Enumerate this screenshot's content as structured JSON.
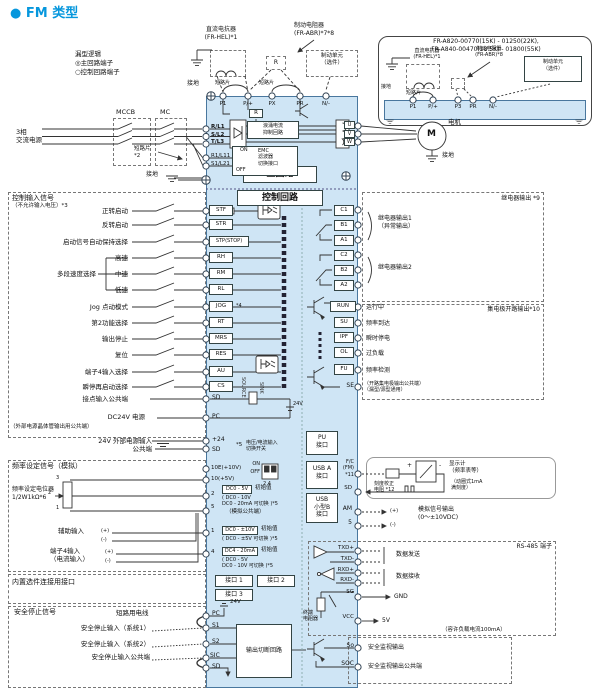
{
  "title": "● FM 类型",
  "legend": {
    "l1": "漏型逻辑",
    "l2": "◎主回路端子",
    "l3": "○控制回路端子"
  },
  "power": {
    "source": "3相\n交流电源",
    "mccb": "MCCB",
    "mc": "MC",
    "jumper": "短路片\n  *2",
    "ground": "接地"
  },
  "reactor": {
    "label": "直流电抗器\n(FR-HEL)*1",
    "ground": "接地",
    "jumper1": "短路片",
    "jumper2": "短路片"
  },
  "brake": {
    "resistor": "制动电阻器\n(FR-ABR)*7*8",
    "unit": "制动单元\n（选件）",
    "r": "R"
  },
  "inset": {
    "title": "FR-A820-00770(15K) - 01250(22K),\nFR-A840-00470(18.5K) - 01800(55K)",
    "reactor": "直流电抗器\n(FR-HEL)*1",
    "resistor": "制动电阻器\n(FR-ABR)*8",
    "unit": "制动单元\n（选件）",
    "ground": "接地",
    "jumper": "短路片",
    "t": [
      "P1",
      "P/+",
      "P3",
      "PR",
      "N/-"
    ]
  },
  "motor": {
    "m": "M",
    "label": "电机",
    "ground": "接地"
  },
  "body": {
    "main": "主回路",
    "ctrl": "控制回路",
    "r": "R",
    "surge": "浪涌电流\n抑制回路",
    "emc_on": "ON",
    "emc_off": "OFF",
    "emc": "EMC\n滤波器\n切换接口",
    "pe": "接地"
  },
  "t_top": [
    "P1",
    "P/+",
    "PX",
    "PR",
    "N/-"
  ],
  "t_in": [
    "R/L1",
    "S/L2",
    "T/L3",
    "R1/L11",
    "S1/L21"
  ],
  "t_out": [
    "U",
    "V",
    "W"
  ],
  "ci": {
    "title": "控制输入信号",
    "sub": "（不允许输入电压）*3",
    "group": "多段速度选择",
    "rows": [
      {
        "label": "正转启动",
        "t": "STF"
      },
      {
        "label": "反转启动",
        "t": "STR"
      },
      {
        "label": "启动信号自动保持选择",
        "t": "STP(STOP)"
      },
      {
        "label": "高速",
        "t": "RH"
      },
      {
        "label": "中速",
        "t": "RM"
      },
      {
        "label": "低速",
        "t": "RL"
      },
      {
        "label": "Jog 点动模式",
        "t": "JOG"
      },
      {
        "label": "第2功能选择",
        "t": "RT"
      },
      {
        "label": "输出停止",
        "t": "MRS"
      },
      {
        "label": "复位",
        "t": "RES"
      },
      {
        "label": "端子4输入选择",
        "t": "AU"
      },
      {
        "label": "瞬停再启动选择",
        "t": "CS"
      }
    ],
    "jog_note": "*4",
    "sd_label": "接点输入公共端",
    "sd": "SD",
    "pc_label": "DC24V 电源",
    "pc_note": "（外部电源晶体管输出用公共端）",
    "pc": "PC",
    "source": "SOURCE",
    "sink": "SINK",
    "v24": "24V"
  },
  "ext": {
    "label1": "24V 外部电源输入",
    "t1": "+24",
    "label2": "公共端",
    "t2": "SD",
    "note": "*5",
    "sw": "电压/电流输入\n切换开关"
  },
  "an": {
    "title": "频率设定信号（模拟）",
    "t10e": "10E(+10V)",
    "t10": "10(+5V)",
    "t2": "2",
    "t5": "5",
    "t1": "1",
    "t4": "4",
    "pot": "频率设定电位器\n1/2W1kΩ*6",
    "p3": "3",
    "p2": "2",
    "p1": "1",
    "on": "ON",
    "off": "OFF",
    "pins": "2 4",
    "v2i": "DC0 - 5V",
    "v2n": "初始值",
    "v2a": "( DC0 - 10V\n  DC0 - 20mA 可切换 )*5",
    "common": "（模拟公共端）",
    "aux": "辅助输入",
    "plus": "(+)",
    "minus": "(-)",
    "v1i": "DC0 - ±10V",
    "v1n": "初始值",
    "v1a": "( DC0 - ±5V 可切换 )*5",
    "t4l": "端子4输入\n（电流输入）",
    "v4i": "DC4 - 20mA",
    "v4n": "初始值",
    "v4a": "( DC0 - 5V\n  DC0 - 10V 可切换 )*5"
  },
  "opt": {
    "title": "内置选件连接用接口",
    "p1": "接口 1",
    "p2": "接口 2",
    "p3": "接口 3"
  },
  "saf": {
    "title": "安全停止信号",
    "wire": "短路用电线",
    "v24": "24V",
    "pc": "PC",
    "s1": "S1",
    "s2": "S2",
    "sic": "SIC",
    "sd": "SD",
    "l1": "安全停止输入（系统1）",
    "l2": "安全停止输入（系统2）",
    "l3": "安全停止输入公共端",
    "box": "输出切断回路"
  },
  "relay": {
    "title": "继电器输出 *9",
    "t": [
      "C1",
      "B1",
      "A1",
      "C2",
      "B2",
      "A2"
    ],
    "o1": "继电器输出1\n（异常输出）",
    "o2": "继电器输出2"
  },
  "oc": {
    "title": "集电极开路输出*10",
    "rows": [
      {
        "t": "RUN",
        "label": "运行中"
      },
      {
        "t": "SU",
        "label": "频率到达"
      },
      {
        "t": "IPF",
        "label": "瞬时停电"
      },
      {
        "t": "OL",
        "label": "过负载"
      },
      {
        "t": "FU",
        "label": "频率检测"
      }
    ],
    "se": "SE",
    "se_label": "（开路集电极输出公共端）\n（漏型/源型通用）"
  },
  "io": {
    "pu": "PU\n接口",
    "usba": "USB A\n接口",
    "usbb": "USB\n小型B\n接口"
  },
  "meter": {
    "fc": "F/C\n(FM)\n*11",
    "sd": "SD",
    "cal": "刻度校正\n电阻 *12",
    "plus": "+",
    "minus": "-",
    "name": "显示计\n（频率表等）",
    "spec": "（动圈式1mA\n满刻度）"
  },
  "am": {
    "t": "AM",
    "t5": "5",
    "plus": "(+)",
    "minus": "(-)",
    "label": "模拟信号输出\n(0～±10VDC)"
  },
  "rs": {
    "title": "RS-485 端子",
    "txdp": "TXD+",
    "txdm": "TXD-",
    "rxdp": "RXD+",
    "rxdm": "RXD-",
    "sg": "SG",
    "vcc": "VCC",
    "send": "数据发送",
    "recv": "数据接收",
    "gnd": "GND",
    "v5": "5V",
    "note": "（容许负载电流100mA）",
    "res": "终端\n电阻器"
  },
  "so": {
    "t": "So",
    "label": "安全监视输出",
    "tc": "SOC",
    "labelc": "安全监视输出公共端"
  }
}
